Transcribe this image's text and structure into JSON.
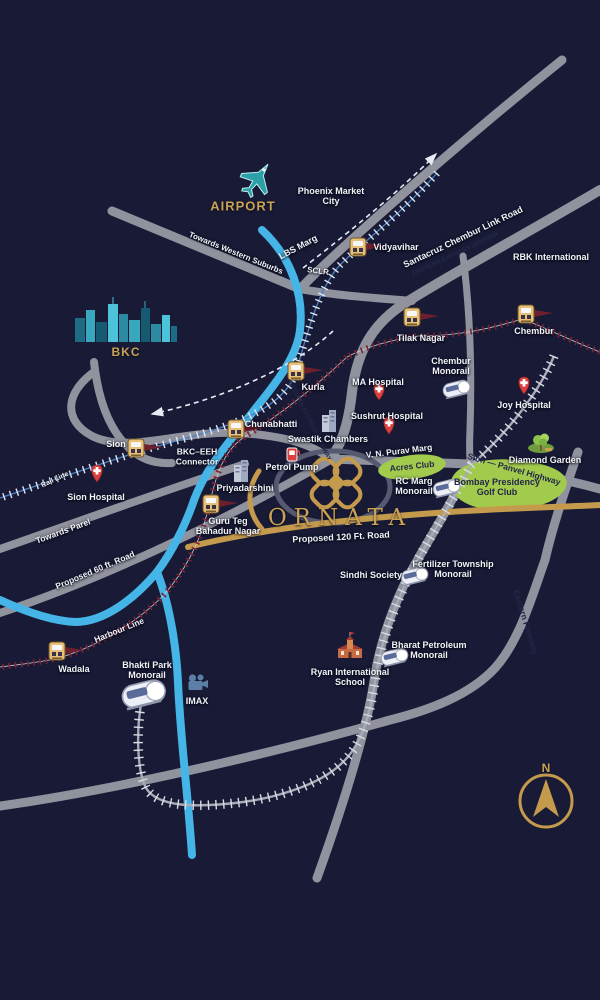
{
  "branding": {
    "project": "ORNATA"
  },
  "compass": {
    "north": "N"
  },
  "areas": {
    "airport": "AIRPORT",
    "bkc": "BKC"
  },
  "roads": {
    "towards_western_suburbs": "Towards Western Suburbs",
    "lbs_marg": "LBS Marg",
    "sclr": "SCLR",
    "sclr_full": "Santacruz Chembur Link Road",
    "eeh": "EASTERN EXPRESS HIGHWAY",
    "vn_purav": "V. N. Purav Marg",
    "sion_panvel": "Sion — Panvel Highway",
    "eastern_freeway": "Eastern Freeway",
    "towards_parel": "Towards Parel",
    "proposed_60": "Proposed 60 ft. Road",
    "proposed_120": "Proposed 120 Ft. Road",
    "bkc_eeh": "BKC–EEH Connector",
    "harbour_line": "Harbour Line",
    "rail_line": "Rail Line"
  },
  "stations": {
    "vidyavihar": "Vidyavihar",
    "chembur": "Chembur",
    "tilak_nagar": "Tilak Nagar",
    "kurla": "Kurla",
    "sion": "Sion",
    "chunabhatti": "Chunabhatti",
    "gtb_nagar": "Guru Teg Bahadur Nagar",
    "wadala": "Wadala"
  },
  "monorail": {
    "chembur": "Chembur Monorail",
    "rc_marg": "RC Marg Monorail",
    "fertilizer": "Fertilizer Township Monorail",
    "bharat_petroleum": "Bharat Petroleum Monorail",
    "bhakti_park": "Bhakti Park Monorail"
  },
  "hospitals": {
    "ma": "MA Hospital",
    "sushrut": "Sushrut Hospital",
    "joy": "Joy Hospital",
    "sion": "Sion Hospital"
  },
  "places": {
    "phoenix": "Phoenix Market City",
    "rbk": "RBK International",
    "swastik": "Swastik Chambers",
    "priyadarshini": "Priyadarshini",
    "petrol_pump": "Petrol Pump",
    "acres_club": "Acres Club",
    "diamond_garden": "Diamond Garden",
    "golf_club": "Bombay Presidency Golf Club",
    "sindhi_society": "Sindhi Society",
    "ryan_school": "Ryan International School",
    "imax": "IMAX"
  },
  "colors": {
    "background": "#191b36",
    "road": "#90939e",
    "river": "#45b5e8",
    "gold_accent": "#c9a254",
    "green_area": "#a2ca4d",
    "hospital_red": "#d9403f",
    "harbour_maroon": "#7d2433"
  }
}
